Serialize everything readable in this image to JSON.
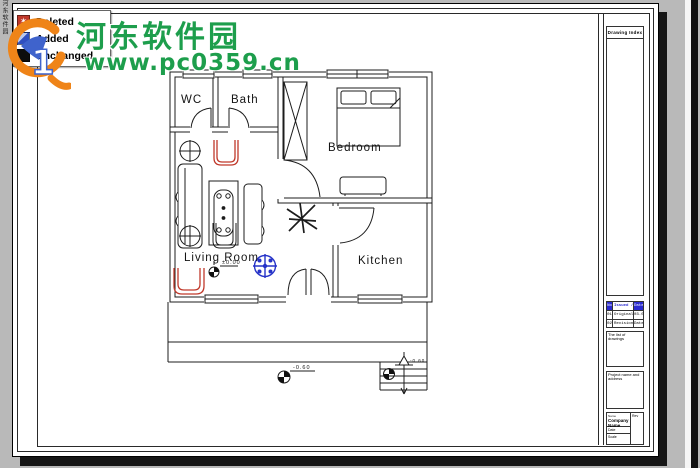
{
  "legend": {
    "items": [
      {
        "label": "Deleted"
      },
      {
        "label": "Added"
      },
      {
        "label": "Unchanged"
      }
    ]
  },
  "watermark": {
    "site_name": "河东软件园",
    "site_url": "www.pc0359.cn",
    "vertical_text": "河东软件园"
  },
  "floor_plan": {
    "rooms": {
      "wc": "WC",
      "bath": "Bath",
      "bedroom": "Bedroom",
      "living": "Living Room",
      "kitchen": "Kitchen"
    },
    "levels": {
      "living": "±0.00",
      "ground": "-0.60",
      "entry": "-0.60"
    }
  },
  "title_block": {
    "header": "Drawing Index",
    "revision_table": {
      "columns": [
        "No",
        "Issued / Sent",
        "Date"
      ],
      "rows": [
        [
          "01",
          "Original",
          "03.05"
        ],
        [
          "02",
          "Revision / Change",
          "Date"
        ]
      ]
    },
    "notes_box_label": "The list of drawings",
    "project_box_label": "Project name and address",
    "info": {
      "name_label": "Name",
      "company": "Company Name",
      "date_label": "Date",
      "scale_label": "Scale",
      "rev_label": "Rev"
    }
  },
  "colors": {
    "deleted_red": "#c0392b",
    "added_blue": "#2633c8",
    "unchanged_black": "#0d0d0d",
    "watermark_green": "#1d9e4c",
    "logo_orange": "#ef8418",
    "logo_blue": "#3f63cc"
  }
}
